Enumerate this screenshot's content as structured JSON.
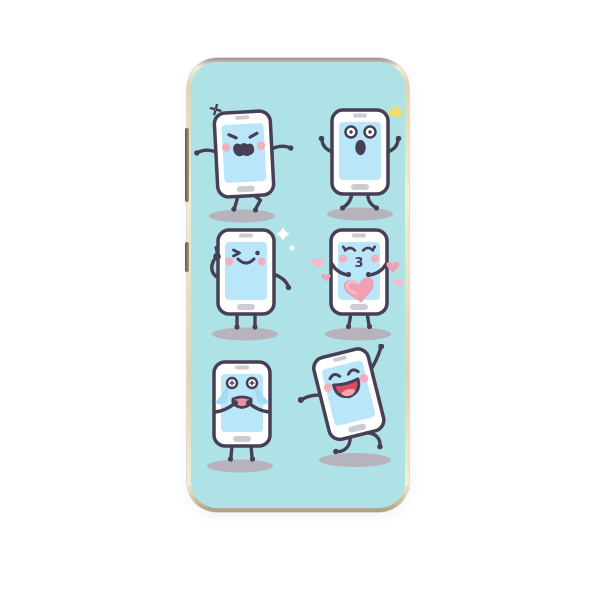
{
  "product": {
    "type": "phone-case",
    "description": "Gold-rimmed smartphone case with mint back printed with six cartoon smartphone emoticon characters"
  },
  "colors": {
    "page-bg": "#ffffff",
    "case-teal": "#aee2e7",
    "frame-top-grey": "#9c9095",
    "frame-gold-light": "#f3eed3",
    "frame-gold": "#ddd4b0",
    "frame-gold-dark": "#a89f80",
    "outline": "#473f54",
    "phone-white": "#fefefe",
    "screen-blue": "#bae6f9",
    "slot-grey": "#cdccd3",
    "cheek-pink": "#f3aebf",
    "heart-pink": "#f29fb3",
    "heart-pink-light": "#f6bac8",
    "tear-blue": "#a6d9f2",
    "cry-mouth-pink": "#ee8fa1",
    "laugh-red": "#da4f64",
    "tongue-pink": "#f5a3b1",
    "sparkle-yellow": "#f2dd66",
    "sparkle-white": "#ffffff",
    "shadow-grey": "#b7b3bc",
    "button-dark": "#5e5a48",
    "button-light": "#a29a7d",
    "notch-cream": "#e3decd"
  },
  "characters": [
    {
      "id": "angry",
      "label": "angry phone with popping-vein mark, arms out, stomping"
    },
    {
      "id": "surprised",
      "label": "shocked phone with round eyes, hands raised, yellow burst"
    },
    {
      "id": "wink",
      "label": "winking phone giving thumbs up with white sparkles"
    },
    {
      "id": "kissing",
      "label": "kissing phone holding a big pink heart, small hearts floating"
    },
    {
      "id": "crying",
      "label": "crying phone with streaming tears, hands at mouth"
    },
    {
      "id": "laughing",
      "label": "tilted dancing phone laughing with arm raised"
    }
  ],
  "glyphs": {
    "kiss_mouth": "3"
  }
}
